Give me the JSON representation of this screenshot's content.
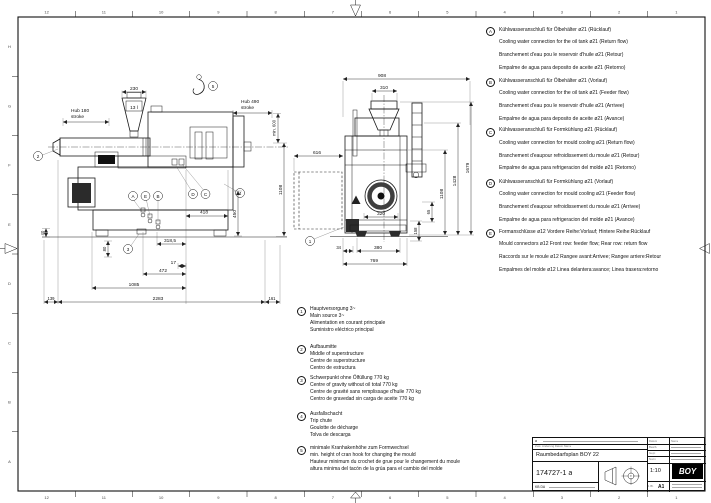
{
  "colors": {
    "line": "#1a1a1a",
    "dark_fill": "#2b2b2b"
  },
  "frame": {
    "top_numbers": [
      "12",
      "11",
      "10",
      "9",
      "8",
      "7",
      "6",
      "5",
      "4",
      "3",
      "2",
      "1"
    ],
    "bottom_numbers": [
      "12",
      "11",
      "10",
      "9",
      "8",
      "7",
      "6",
      "5",
      "4",
      "3",
      "2",
      "1"
    ],
    "left_letters": [
      "H",
      "G",
      "F",
      "E",
      "D",
      "C",
      "B",
      "A"
    ]
  },
  "callouts": {
    "c1": "1",
    "c2": "2",
    "c3": "3",
    "c4": "4",
    "c5": "5",
    "ca": "A",
    "cb": "B",
    "cc": "C",
    "cd": "D",
    "ce": "E"
  },
  "views": {
    "left": {
      "machine_logo": "BOY",
      "dims": {
        "hopper_width": "230",
        "hopper_capacity": "13 l",
        "hub_left_1": "Hub 180",
        "hub_left_2": "stroke",
        "hub_right_1": "Hub 490",
        "hub_right_2": "stroke",
        "min_clearance": "min. 600",
        "h1108": "1108",
        "w418": "418",
        "h450": "450",
        "h40": "40",
        "h80": "80",
        "w318_5": "318,5",
        "w17": "17",
        "w472": "472",
        "w1085": "1085",
        "w2283": "2283",
        "w139": "139",
        "w161": "161"
      }
    },
    "front": {
      "dims": {
        "w908": "908",
        "w310": "310",
        "w616": "616",
        "h1679": "1679",
        "h1428": "1428",
        "h1108": "1108",
        "h65": "65",
        "h158": "158",
        "w320": "320",
        "w380": "380",
        "w769": "769",
        "w34": "34"
      }
    }
  },
  "letter_notes": [
    {
      "id": "A",
      "lines": [
        "Kühlwasseranschluß für Ölbehälter ø21 (Rücklauf)",
        "Cooling water connection for the oil tank ø21 (Return flow)",
        "Branchement d'eau pou le reservoir d'huile ø21 (Retour)",
        "Empalme de agua para deposito de aceite ø21 (Retorno)"
      ]
    },
    {
      "id": "B",
      "lines": [
        "Kühlwasseranschluß für Ölbehälter ø21 (Vorlauf)",
        "Cooling water connection for the oil tank ø21 (Feeder flow)",
        "Branchement d'eau pou le reservoir d'huile ø21 (Arrivee)",
        "Empalme de agua para deposito de aceite ø21 (Avance)"
      ]
    },
    {
      "id": "C",
      "lines": [
        "Kühlwasseranschluß für Formkühlung ø21 (Rücklauf)",
        "Cooling water connection for mould cooling ø21 (Return flow)",
        "Branchement d'eaupour refroidissement du moule ø21 (Retour)",
        "Empalme de agua para refrigeracion del molde ø21 (Retorno)"
      ]
    },
    {
      "id": "D",
      "lines": [
        "Kühlwasseranschluß für Formkühlung ø21 (Vorlauf)",
        "Cooling water connection for mould cooling ø21 (Feeder flow)",
        "Branchement d'eaupour refroidissement du moule ø21 (Arrivee)",
        "Empalme de agua para refrigeracion del molde ø21 (Avance)"
      ]
    },
    {
      "id": "E",
      "lines": [
        "Formanschlüsse ø12 Vordere Reihe:Vorlauf; Hintere Reihe:Rücklauf",
        "Mould connectors ø12 Front row: feeder flow; Rear row: return flow",
        "Raccords sur le moule ø12 Rangee avant:Arrivee; Rangee arriere:Retour",
        "Empalmes del molde ø12 Linea delantera:avance; Linea trasera:retorno"
      ]
    }
  ],
  "number_notes": [
    {
      "id": "1",
      "lines": [
        "Hauptversorgung 3~",
        "Main source 3~",
        "Alimentation en courant principale",
        "Suministro eléctrico principal"
      ]
    },
    {
      "id": "2",
      "lines": [
        "Aufbaumitte",
        "Middle of superstructure",
        "Centre de superstructure",
        "Centro de estructura"
      ]
    },
    {
      "id": "3",
      "lines": [
        "Schwerpunkt ohne Ölfüllung 770 kg",
        "Centre of gravity without oil total 770 kg",
        "Centre de gravité sans remplissage d'huile 770 kg",
        "Centro de gravedad sin carga de aceite 770 kg"
      ]
    },
    {
      "id": "4",
      "lines": [
        "Ausfallschacht",
        "Trip chute",
        "Goulotte de décharge",
        "Tolva de descarga"
      ]
    },
    {
      "id": "5",
      "lines": [
        "minimale Kranhakenhöhe zum Formwechsel",
        "min. height of cran hook for changing the mould",
        "Hauteur minimum du crochet de grue pour le changement du moule",
        "altura minima del tacón de la grúa para el cambio del molde"
      ]
    }
  ],
  "title_block": {
    "title": "Raumbedarfsplan BOY 22",
    "drawing_number": "174727-1 a",
    "scale": "1:10",
    "format": "A1",
    "sheet": "1 Bl.",
    "dept_code": "KB DA",
    "revision_mark": "a",
    "logo_text": "BOY",
    "revision_header": "Zust.   Änderung   Datum   Name",
    "fields": {
      "r1l": "Datum",
      "r1r": "Name",
      "r2": "Bearb.",
      "r3": "Gepr.",
      "r4": "Norm"
    }
  }
}
